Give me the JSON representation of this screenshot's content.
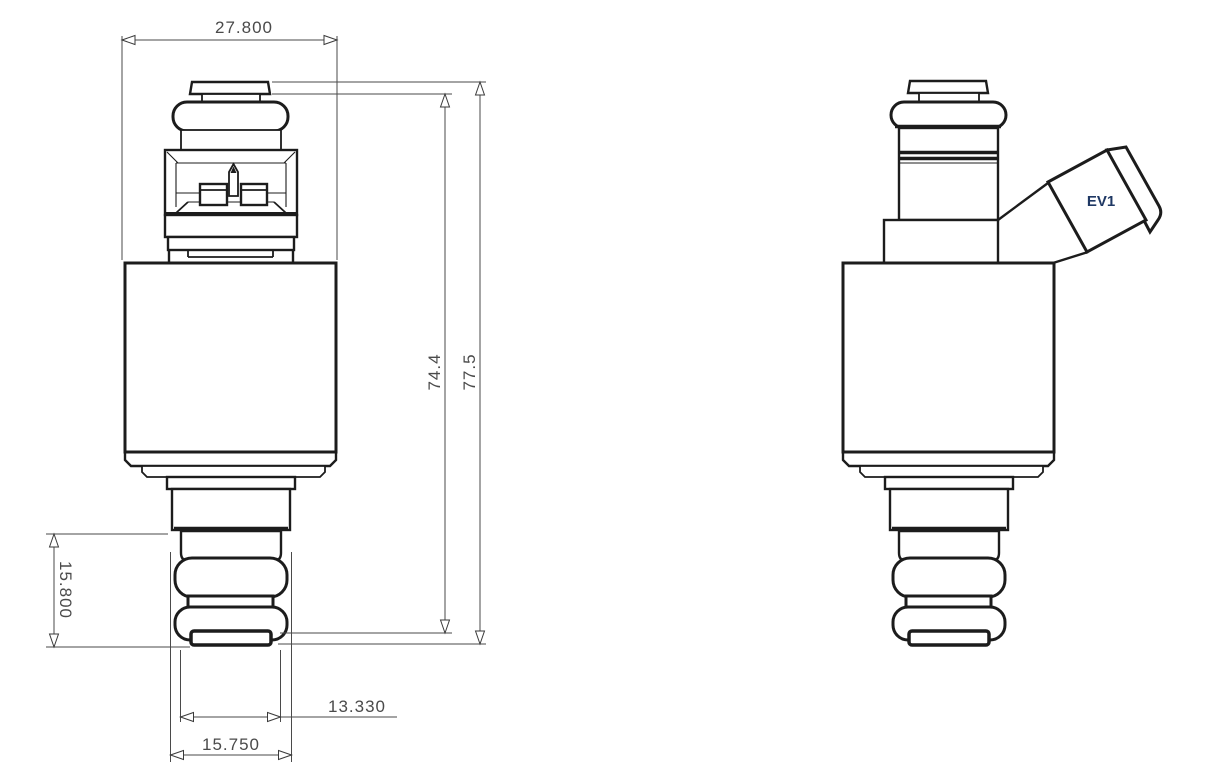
{
  "drawing": {
    "part": "EV1 fuel injector",
    "background_color": "#ffffff",
    "outline_color": "#1c1c1c",
    "dimension_color": "#4a4a4a",
    "connector_label_color": "#1f3864",
    "connector_label": "EV1",
    "dimensions": {
      "overall_width": "27.800",
      "upper_height": "74.4",
      "overall_height": "77.5",
      "lower_section_height": "15.800",
      "nozzle_width_inner": "13.330",
      "nozzle_width_outer": "15.750"
    }
  }
}
